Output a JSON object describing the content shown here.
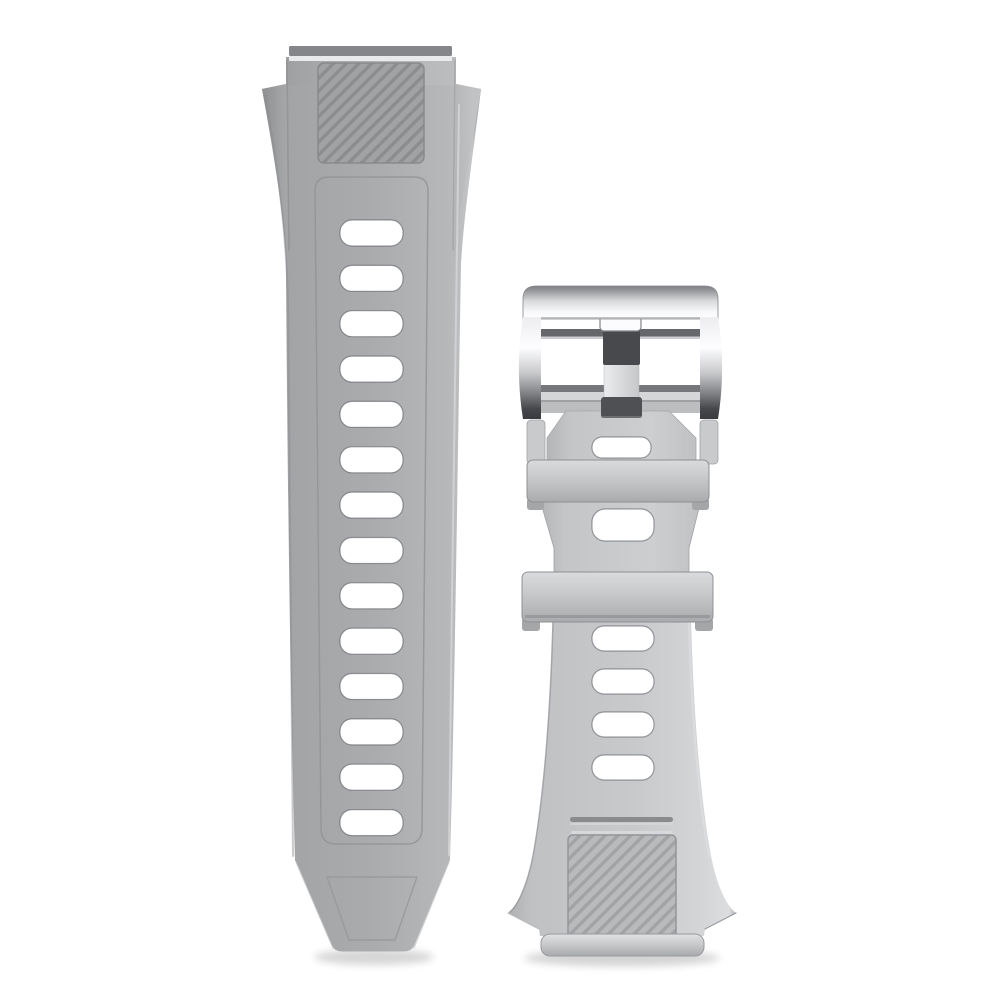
{
  "scene": {
    "type": "product-photo",
    "description": "Gray silicone smartwatch replacement strap set on a white background: a long band with adjustment holes and ribbed grip panel on the left, and a shorter buckle band with a polished silver pin buckle, two keeper loops and a ribbed tip panel on the right",
    "background_color": "#ffffff"
  },
  "left_strap": {
    "label": "long-strap",
    "adjustment_hole_count": 14,
    "texture": "diagonal ribbed grip panel",
    "body_color": "#a9aaac",
    "connector_bar_color": "#85868a",
    "connector_bar_highlight": "#e9eaec",
    "panel_base_color": "#a1a2a4",
    "panel_stripe_color": "#8c8d8f"
  },
  "right_strap": {
    "label": "buckle-strap",
    "keeper_loop_count": 2,
    "upper_hole_count": 2,
    "lower_hole_count": 4,
    "texture": "diagonal ribbed grip panel",
    "body_color": "#c7c8ca",
    "panel_base_color": "#b9babc",
    "panel_stripe_color": "#a2a3a5",
    "fold_band_color": "#bcbdbf"
  },
  "buckle": {
    "label": "pin-buckle",
    "finish": "polished silver metal",
    "highlight_color": "#fafbfd",
    "shadow_color": "#3a3b3f",
    "crossbar_color": "#66676b",
    "frame_bottom_bar_color": "#76777b",
    "prong_color": "#48494d",
    "prong_band_color": "#4f5054",
    "prong_tab_color": "#fcfcfe"
  },
  "shadow": {
    "color": "#000000"
  }
}
